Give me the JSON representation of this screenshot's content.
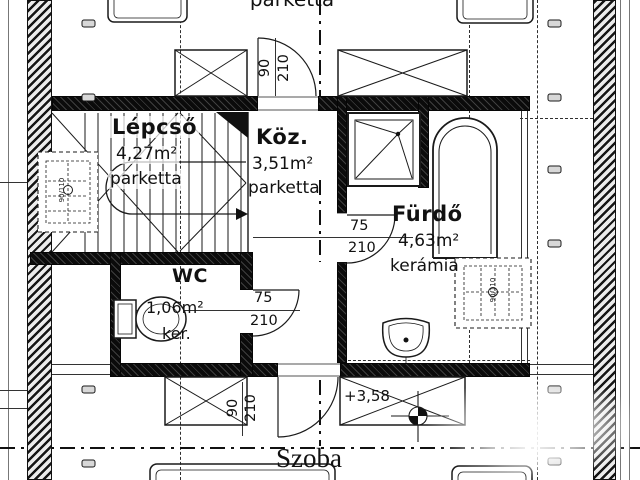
{
  "plan": {
    "background": "#ffffff",
    "line_color": "#1a1a1a",
    "rooms": {
      "lepcso": {
        "name": "Lépcső",
        "area": "4,27m²",
        "floor": "parketta"
      },
      "koz": {
        "name": "Köz.",
        "area": "3,51m²",
        "floor": "parketta"
      },
      "wc": {
        "name": "WC",
        "area": "1,06m²",
        "floor": "ker."
      },
      "furdo": {
        "name": "Fürdő",
        "area": "4,63m²",
        "floor": "kerámia"
      },
      "szoba": {
        "name": "Szoba"
      },
      "top_room": {
        "floor": "parketta"
      }
    },
    "doors": {
      "top": {
        "w": "90",
        "h": "210"
      },
      "bottom": {
        "w": "90",
        "h": "210"
      },
      "wc": {
        "w": "75",
        "h": "210"
      },
      "bath": {
        "w": "75",
        "h": "210"
      }
    },
    "level_mark": "+3,58",
    "roof_window_label": "90/110"
  }
}
